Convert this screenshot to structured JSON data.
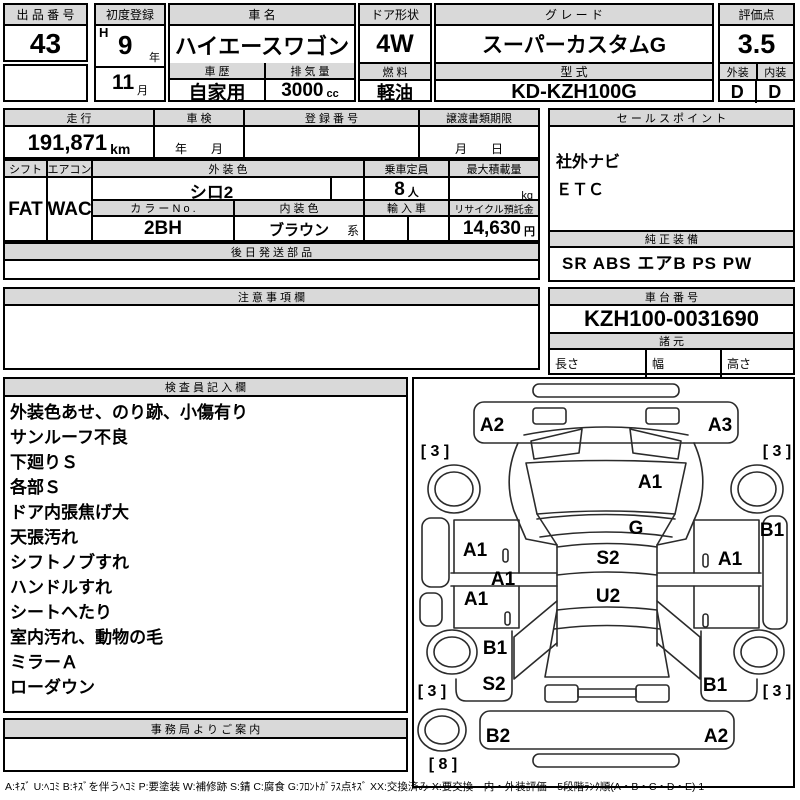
{
  "header": {
    "auction_no_label": "出 品 番 号",
    "auction_no": "43",
    "first_reg_label": "初度登録",
    "first_reg_era": "H",
    "first_reg_year": "9",
    "first_reg_year_suffix": "年",
    "first_reg_month": "11",
    "first_reg_month_suffix": "月",
    "car_name_label": "車  名",
    "car_name": "ハイエースワゴン",
    "history_label": "車 歴",
    "history": "自家用",
    "displacement_label": "排 気 量",
    "displacement": "3000",
    "displacement_unit": "cc",
    "door_label": "ドア形状",
    "door": "4W",
    "fuel_label": "燃 料",
    "fuel": "軽油",
    "grade_label": "グ レ ー ド",
    "grade": "スーパーカスタムG",
    "model_label": "型 式",
    "model": "KD-KZH100G",
    "score_label": "評価点",
    "score": "3.5",
    "exterior_label": "外装",
    "exterior_grade": "D",
    "interior_label": "内装",
    "interior_grade": "D"
  },
  "mid": {
    "mileage_label": "走 行",
    "mileage": "191,871",
    "mileage_unit": "km",
    "shaken_label": "車 検",
    "shaken_value": "年　　月",
    "reg_no_label": "登 録 番 号",
    "transfer_label": "譲渡書類期限",
    "transfer_value": "月　　日",
    "shift_label": "シフト",
    "shift": "FAT",
    "aircon_label": "エアコン",
    "aircon": "WAC",
    "ext_color_label": "外 装 色",
    "ext_color": "シロ2",
    "capacity_label": "乗車定員",
    "capacity": "8",
    "capacity_unit": "人",
    "max_load_label": "最大積載量",
    "max_load_unit": "kg",
    "color_no_label": "カ ラ ー N o .",
    "color_no": "2BH",
    "int_color_label": "内 装 色",
    "int_color": "ブラウン",
    "int_color_suffix": "系",
    "import_label": "輸 入 車",
    "recycle_label": "リサイクル預託金",
    "recycle_value": "14,630",
    "recycle_unit": "円",
    "later_parts_label": "後 日 発 送 部 品",
    "caution_label": "注 意 事 項 欄"
  },
  "right": {
    "sales_point_label": "セ ー ル ス ポ イ ン ト",
    "sales_points": [
      "社外ナビ",
      "ＥＴＣ"
    ],
    "oem_label": "純 正 装 備",
    "oem_value": "SR ABS エアB PS PW",
    "chassis_label": "車 台 番 号",
    "chassis_no": "KZH100-0031690",
    "spec_label": "諸 元",
    "length_label": "長さ",
    "width_label": "幅",
    "height_label": "高さ"
  },
  "inspection": {
    "label": "検 査 員 記 入 欄",
    "notes": [
      "外装色あせ、のり跡、小傷有り",
      "サンルーフ不良",
      "下廻りＳ",
      "各部Ｓ",
      "ドア内張焦げ大",
      "天張汚れ",
      "シフトノブすれ",
      "ハンドルすれ",
      "シートへたり",
      "室内汚れ、動物の毛",
      "ミラーＡ",
      "ローダウン"
    ]
  },
  "office": {
    "label": "事 務 局 よ り ご 案 内"
  },
  "diagram": {
    "marks": [
      {
        "t": "A2",
        "x": 78,
        "y": 47
      },
      {
        "t": "A3",
        "x": 306,
        "y": 47
      },
      {
        "t": "[ 3 ]",
        "x": 21,
        "y": 73,
        "fs": 16
      },
      {
        "t": "[ 3 ]",
        "x": 363,
        "y": 73,
        "fs": 16
      },
      {
        "t": "A1",
        "x": 236,
        "y": 104
      },
      {
        "t": "G",
        "x": 222,
        "y": 150
      },
      {
        "t": "S2",
        "x": 194,
        "y": 180
      },
      {
        "t": "U2",
        "x": 194,
        "y": 218
      },
      {
        "t": "A1",
        "x": 61,
        "y": 172
      },
      {
        "t": "A1",
        "x": 89,
        "y": 201
      },
      {
        "t": "A1",
        "x": 62,
        "y": 221
      },
      {
        "t": "B1",
        "x": 81,
        "y": 270
      },
      {
        "t": "S2",
        "x": 80,
        "y": 306
      },
      {
        "t": "A1",
        "x": 316,
        "y": 181
      },
      {
        "t": "B1",
        "x": 358,
        "y": 152
      },
      {
        "t": "B1",
        "x": 301,
        "y": 307
      },
      {
        "t": "B2",
        "x": 84,
        "y": 358
      },
      {
        "t": "A2",
        "x": 302,
        "y": 358
      },
      {
        "t": "[ 3 ]",
        "x": 18,
        "y": 313,
        "fs": 16
      },
      {
        "t": "[ 3 ]",
        "x": 363,
        "y": 313,
        "fs": 16
      },
      {
        "t": "[ 8 ]",
        "x": 29,
        "y": 386,
        "fs": 16
      }
    ]
  },
  "legend": "A:ｷｽﾞ U:ﾍｺﾐ B:ｷｽﾞを伴うﾍｺﾐ P:要塗装 W:補修跡 S:錆 C:腐食 G:ﾌﾛﾝﾄｶﾞﾗｽ点ｷｽﾞ XX:交換済み X:要交換　内・外装評価　5段階ﾗﾝｸ順(A・B・C・D・E) 1"
}
